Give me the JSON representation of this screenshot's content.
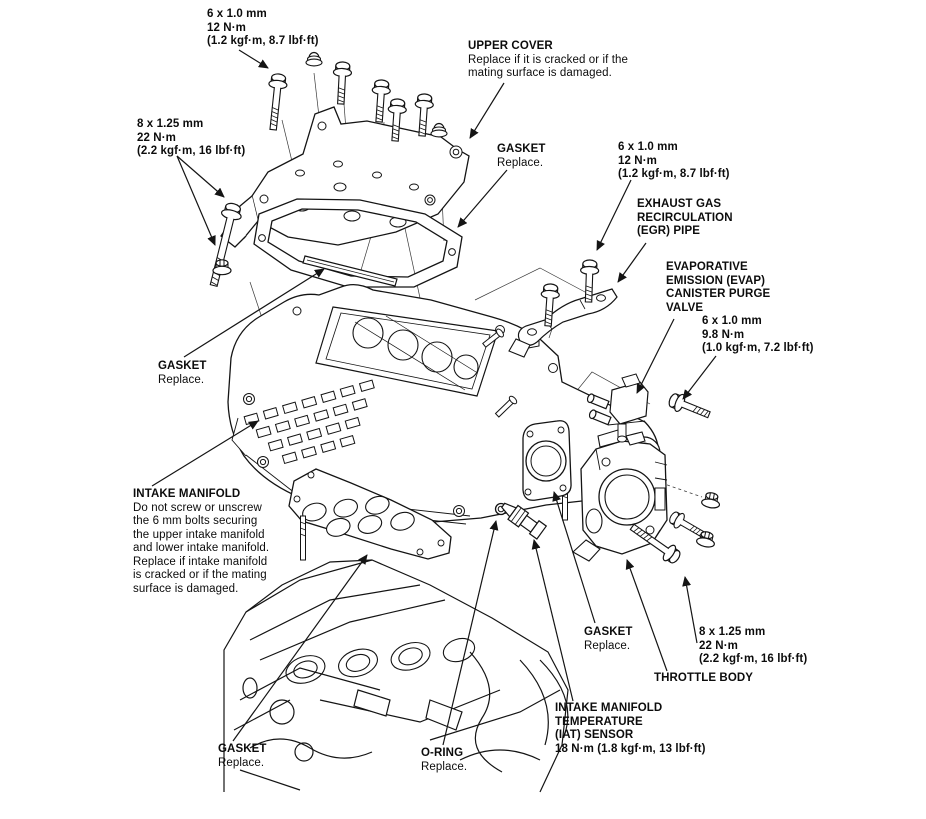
{
  "colors": {
    "ink": "#141414",
    "background": "#ffffff"
  },
  "labels": {
    "torque_6x10_top": {
      "lines": [
        "6 x 1.0 mm",
        "12 N·m",
        "(1.2 kgf·m, 8.7 lbf·ft)"
      ]
    },
    "upper_cover": {
      "title": "UPPER COVER",
      "desc": [
        "Replace if it is cracked or if the",
        "mating surface is damaged."
      ]
    },
    "torque_8x125_left": {
      "lines": [
        "8 x 1.25 mm",
        "22 N·m",
        "(2.2 kgf·m, 16 lbf·ft)"
      ]
    },
    "gasket_upper": {
      "title": "GASKET",
      "desc": [
        "Replace."
      ]
    },
    "torque_6x10_egr": {
      "lines": [
        "6 x 1.0 mm",
        "12 N·m",
        "(1.2 kgf·m, 8.7 lbf·ft)"
      ]
    },
    "egr_pipe": {
      "lines": [
        "EXHAUST GAS",
        "RECIRCULATION",
        "(EGR) PIPE"
      ]
    },
    "evap_valve": {
      "lines": [
        "EVAPORATIVE",
        "EMISSION (EVAP)",
        "CANISTER PURGE",
        "VALVE"
      ]
    },
    "torque_6x10_evap": {
      "lines": [
        "6 x 1.0 mm",
        "9.8 N·m",
        "(1.0 kgf·m, 7.2 lbf·ft)"
      ]
    },
    "gasket_strip": {
      "title": "GASKET",
      "desc": [
        "Replace."
      ]
    },
    "intake_manifold": {
      "title": "INTAKE MANIFOLD",
      "desc": [
        "Do not screw or unscrew",
        "the 6 mm bolts securing",
        "the upper intake manifold",
        "and lower intake manifold.",
        "Replace if intake manifold",
        "is cracked or if the mating",
        "surface is damaged."
      ]
    },
    "gasket_throttle": {
      "title": "GASKET",
      "desc": [
        "Replace."
      ]
    },
    "torque_8x125_right": {
      "lines": [
        "8 x 1.25 mm",
        "22 N·m",
        "(2.2 kgf·m, 16 lbf·ft)"
      ]
    },
    "throttle_body": {
      "title": "THROTTLE BODY"
    },
    "iat_sensor": {
      "lines": [
        "INTAKE MANIFOLD",
        "TEMPERATURE",
        "(IAT) SENSOR",
        "18 N·m (1.8 kgf·m, 13 lbf·ft)"
      ]
    },
    "gasket_lower": {
      "title": "GASKET",
      "desc": [
        "Replace."
      ]
    },
    "o_ring": {
      "title": "O-RING",
      "desc": [
        "Replace."
      ]
    }
  }
}
